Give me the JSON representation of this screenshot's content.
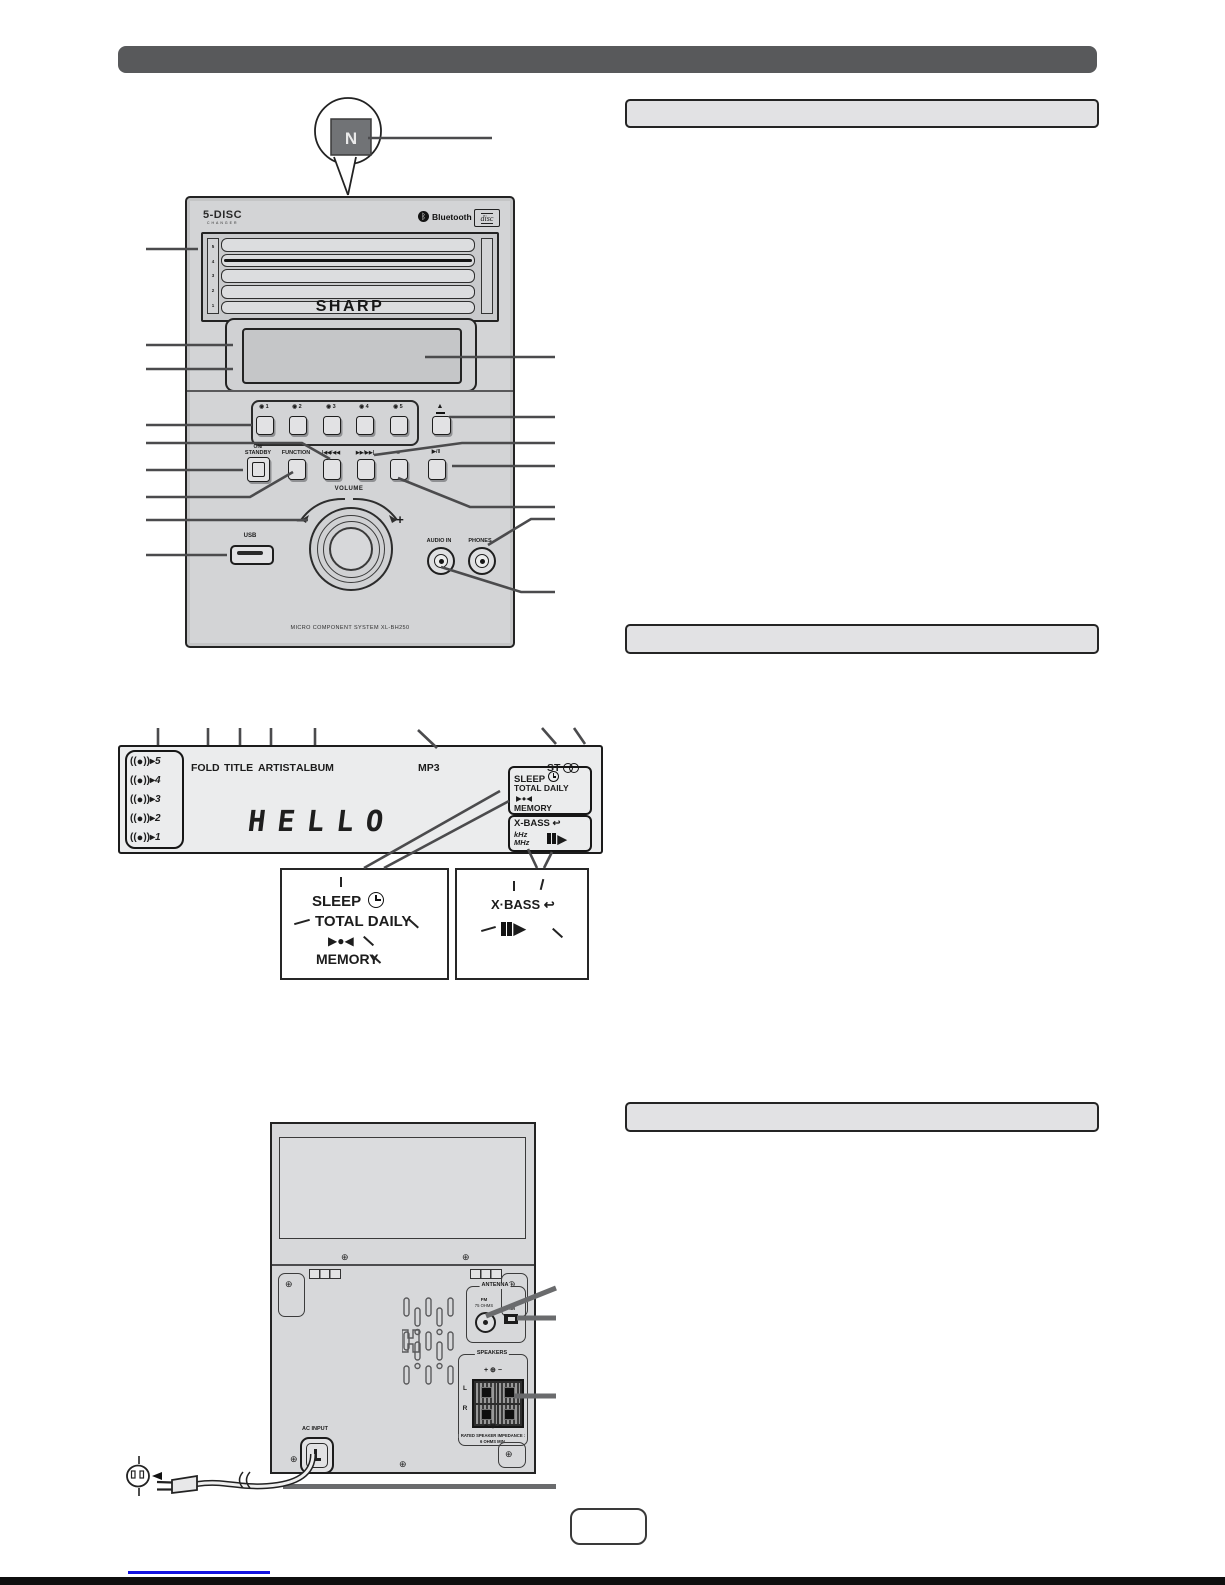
{
  "front_panel": {
    "changer_logo": "5-DISC",
    "changer_logo_sub": "CHANGER",
    "bluetooth_icon": "ᛒ",
    "bluetooth_label": "Bluetooth",
    "cd_logo": "disc",
    "brand": "SHARP",
    "slot_numbers": [
      "5",
      "4",
      "3",
      "2",
      "1"
    ],
    "disc_button_icon": "◉",
    "disc_buttons": [
      "1",
      "2",
      "3",
      "4",
      "5"
    ],
    "eject_icon": "▲",
    "standby_top": "ON/",
    "standby_bottom": "STANDBY",
    "function_label": "FUNCTION",
    "prev_label": "|◀◀/◀◀",
    "next_label": "▶▶/▶▶|",
    "stop_label": "■",
    "play_pause_label": "▶/‖",
    "volume_label": "VOLUME",
    "minus": "−",
    "plus": "+",
    "usb_label": "USB",
    "audio_in_label": "AUDIO IN",
    "phones_label": "PHONES",
    "model_text": "MICRO COMPONENT SYSTEM XL-BH250"
  },
  "display": {
    "disc_icon_left": "((",
    "disc_icon_right": "))",
    "disc_arrow": "▸",
    "disc_numbers": [
      "5",
      "4",
      "3",
      "2",
      "1"
    ],
    "fold": "FOLD",
    "title": "TITLE",
    "artist": "ARTIST",
    "album": "ALBUM",
    "mp3": "MP3",
    "st": "ST",
    "main_text": "HELLO",
    "sleep": "SLEEP",
    "total": "TOTAL",
    "daily": "DAILY",
    "record_icons": "▶●◀",
    "memory": "MEMORY",
    "xbass": "X-BASS",
    "xbass_loop_icon": "↩",
    "khz": "kHz",
    "mhz": "MHz",
    "play_icon": "▶"
  },
  "magnified_left": {
    "sleep": "SLEEP",
    "total": "TOTAL",
    "daily": "DAILY",
    "record_icons": "▶●◀",
    "memory": "MEMORY"
  },
  "magnified_right": {
    "xbass": "X·BASS",
    "loop_icon": "↩",
    "play_icon": "▶"
  },
  "rear_panel": {
    "antenna_title": "ANTENNA",
    "fm": "FM",
    "fm_ohms": "75 OHMS",
    "am": "AM",
    "speakers_title": "SPEAKERS",
    "plus": "+",
    "minus": "−",
    "left": "L",
    "right": "R",
    "rated_line1": "RATED SPEAKER IMPEDANCE :",
    "rated_line2": "6 OHMS MIN.",
    "ac_input": "AC INPUT"
  }
}
